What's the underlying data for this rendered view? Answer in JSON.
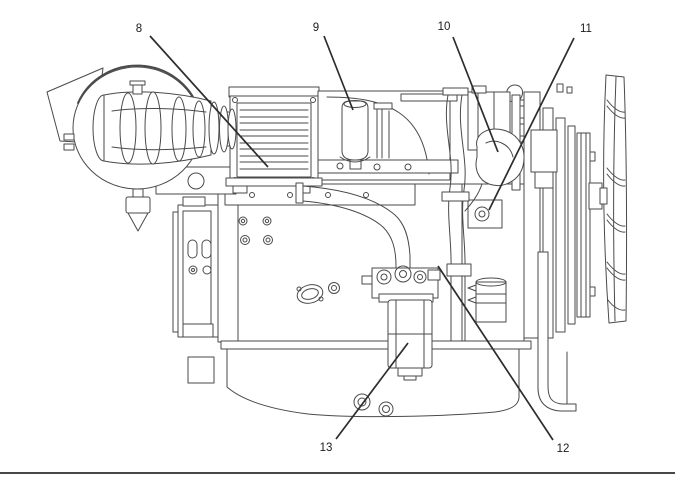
{
  "page": {
    "background": "#ffffff",
    "footer_rule_color": "#474747"
  },
  "figure": {
    "line_color": "#4a4a4a",
    "callout_style": {
      "font_size": 11.5,
      "text_color": "#1b1b1b",
      "leader_color": "#2d2d2d",
      "leader_width": 1.7
    },
    "callouts": [
      {
        "label": "8",
        "label_x": 139,
        "label_y": 28,
        "line": {
          "x1": 150,
          "y1": 36,
          "x2": 268,
          "y2": 167
        }
      },
      {
        "label": "9",
        "label_x": 316,
        "label_y": 27,
        "line": {
          "x1": 324,
          "y1": 36,
          "x2": 353,
          "y2": 110
        }
      },
      {
        "label": "10",
        "label_x": 444,
        "label_y": 26,
        "line": {
          "x1": 453,
          "y1": 37,
          "x2": 498,
          "y2": 152
        }
      },
      {
        "label": "11",
        "label_x": 586,
        "label_y": 28,
        "line": {
          "x1": 574,
          "y1": 38,
          "x2": 489,
          "y2": 210
        }
      },
      {
        "label": "12",
        "label_x": 563,
        "label_y": 448,
        "line": {
          "x1": 553,
          "y1": 440,
          "x2": 438,
          "y2": 266
        }
      },
      {
        "label": "13",
        "label_x": 326,
        "label_y": 447,
        "line": {
          "x1": 336,
          "y1": 439,
          "x2": 408,
          "y2": 343
        }
      }
    ]
  }
}
